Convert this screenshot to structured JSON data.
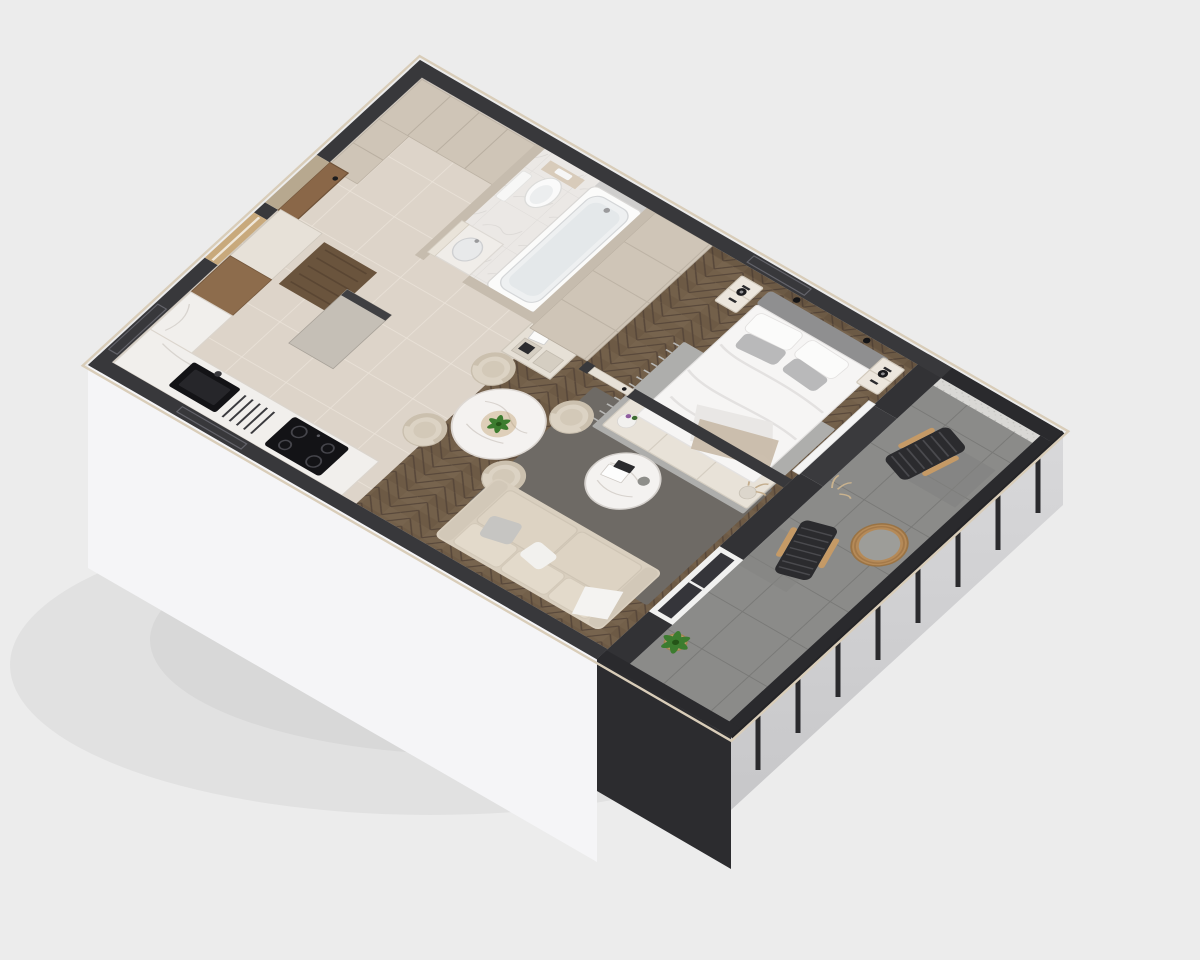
{
  "scene": {
    "type": "isometric-3d-floor-plan-cutaway-render",
    "background": "#ececec",
    "apartment": {
      "rooms": [
        {
          "name": "entry-hall",
          "floor": "beige-ceramic-tile",
          "items": [
            "entry-door-open",
            "doormat",
            "entry-wardrobe-cabinets",
            "tall-gray-cabinet"
          ]
        },
        {
          "name": "kitchen",
          "floor": "beige-ceramic-tile",
          "items": [
            "l-shaped-marble-counter",
            "black-sink",
            "drainer-grooves",
            "black-induction-cooktop",
            "tall-cream-cabinet",
            "wood-front-cabinet"
          ]
        },
        {
          "name": "bathroom",
          "floor": "white-marble-tile",
          "items": [
            "bathtub",
            "wall-hung-toilet",
            "flush-panel",
            "vanity-basin",
            "hanging-towel",
            "bathroom-door-open"
          ]
        },
        {
          "name": "living-dining-room",
          "floor": "oak-herringbone",
          "items": [
            "round-marble-dining-table",
            "dining-chair-x4",
            "table-plant",
            "beige-sofa",
            "sofa-pillows",
            "white-throw",
            "round-marble-coffee-table",
            "books",
            "dark-area-rug",
            "tv-console",
            "tv",
            "flower-pot",
            "dried-flower-vase",
            "open-shelf-unit",
            "balcony-sliding-door"
          ]
        },
        {
          "name": "bedroom",
          "floor": "oak-herringbone",
          "items": [
            "double-bed",
            "gray-headboard",
            "pillows-x4",
            "beige-throw",
            "nightstand-x2",
            "table-lamp-x2",
            "wardrobe",
            "gray-fringed-rug",
            "white-curtain",
            "bedroom-door"
          ]
        },
        {
          "name": "balcony",
          "floor": "gray-concrete-tile",
          "items": [
            "rope-lounge-chair-x2",
            "rattan-drum-table",
            "potted-plant-x2",
            "dried-sprigs",
            "metal-railing",
            "speckled-wall"
          ]
        }
      ],
      "counts": {
        "dining_chairs": 4,
        "lounge_chairs": 2,
        "nightstands": 2,
        "rooms": 6
      }
    },
    "palette": {
      "wall_cap": "#38383b",
      "wall_interior": "#c6bcae",
      "wall_balcony": "#323235",
      "railing_dark": "#2a2a2d",
      "facade_white": "#f5f5f7",
      "facade_dark": "#2c2c2f",
      "parapet_gray": "#d3d3d5",
      "floor_tile": "#ddd4c9",
      "floor_wood": "#73604a",
      "floor_balcony": "#8b8b89",
      "floor_marble": "#ebe8e5",
      "rug_living": "#6e6a65",
      "rug_bedroom": "#aeaeac",
      "sofa": "#d9cfbf",
      "bedding": "#f6f5f4",
      "headboard": "#8f8f90",
      "counter_marble": "#f1efec",
      "cabinet_beige": "#cfc5b7",
      "appliance_black": "#131316",
      "marble_top": "#f4f2f0",
      "brass": "#b48f52",
      "rattan": "#b58a58",
      "plant_green": "#3c7c2f",
      "door_wood": "#8a6748",
      "doormat": "#6a543d",
      "curtain_white": "#f4f4f4",
      "speckle_wall": "#d9d8d5"
    }
  }
}
